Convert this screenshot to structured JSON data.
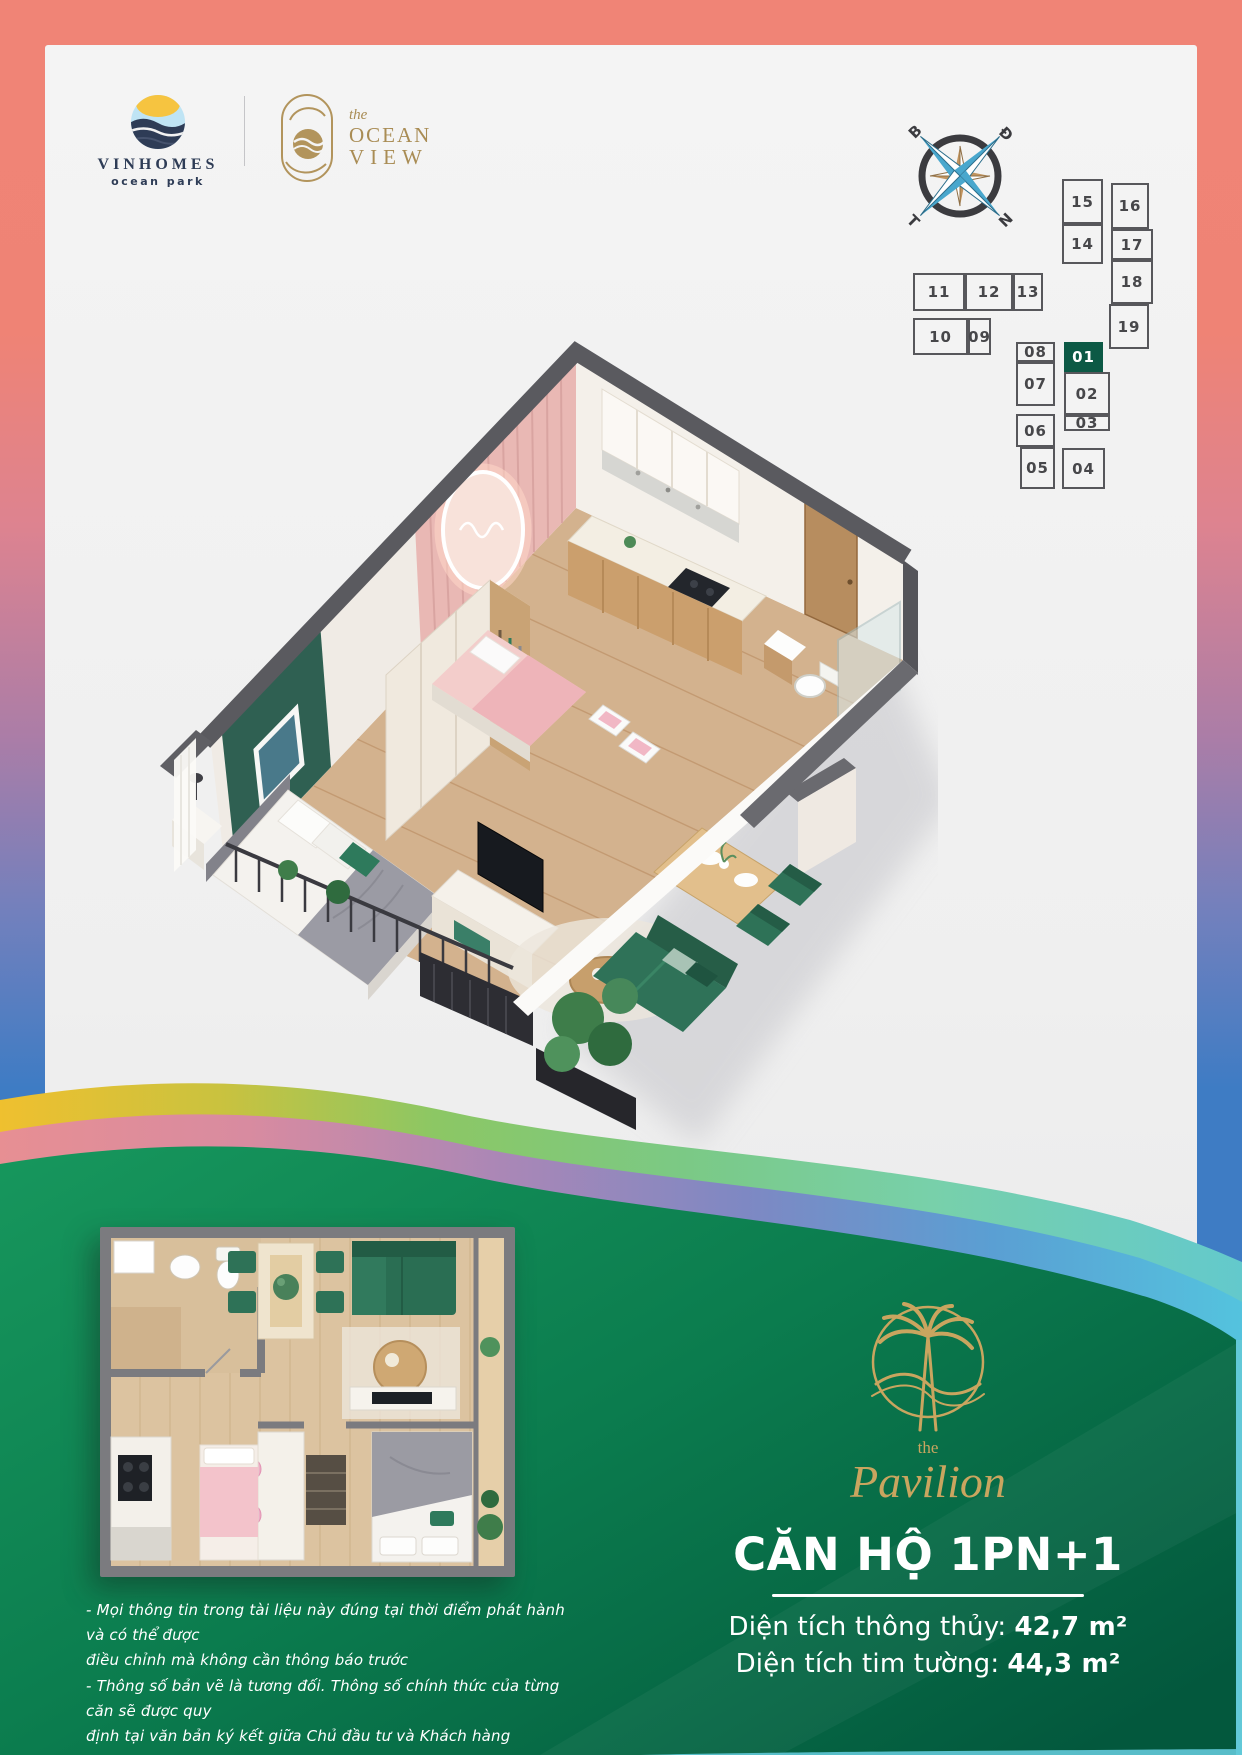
{
  "header": {
    "vinhomes": {
      "name": "VINHOMES",
      "subtitle": "ocean park"
    },
    "ocean_view": {
      "prefix": "the",
      "line1": "OCEAN",
      "line2": "VIEW"
    }
  },
  "compass": {
    "north_label": "B",
    "east_label": "Đ",
    "south_label": "N",
    "west_label": "T"
  },
  "site_plan": {
    "highlighted_unit": "01",
    "units": [
      {
        "label": "15",
        "x": 1062,
        "y": 179,
        "w": 41,
        "h": 45
      },
      {
        "label": "14",
        "x": 1062,
        "y": 224,
        "w": 41,
        "h": 40
      },
      {
        "label": "16",
        "x": 1111,
        "y": 183,
        "w": 38,
        "h": 46
      },
      {
        "label": "17",
        "x": 1111,
        "y": 229,
        "w": 42,
        "h": 31
      },
      {
        "label": "18",
        "x": 1111,
        "y": 260,
        "w": 42,
        "h": 44
      },
      {
        "label": "19",
        "x": 1109,
        "y": 304,
        "w": 40,
        "h": 45
      },
      {
        "label": "11",
        "x": 913,
        "y": 273,
        "w": 52,
        "h": 38
      },
      {
        "label": "12",
        "x": 965,
        "y": 273,
        "w": 48,
        "h": 38
      },
      {
        "label": "13",
        "x": 1013,
        "y": 273,
        "w": 30,
        "h": 38
      },
      {
        "label": "10",
        "x": 913,
        "y": 318,
        "w": 55,
        "h": 37
      },
      {
        "label": "09",
        "x": 968,
        "y": 318,
        "w": 23,
        "h": 37
      },
      {
        "label": "08",
        "x": 1016,
        "y": 342,
        "w": 39,
        "h": 20
      },
      {
        "label": "07",
        "x": 1016,
        "y": 362,
        "w": 39,
        "h": 44
      },
      {
        "label": "06",
        "x": 1016,
        "y": 414,
        "w": 39,
        "h": 33
      },
      {
        "label": "05",
        "x": 1020,
        "y": 447,
        "w": 35,
        "h": 42
      },
      {
        "label": "01",
        "x": 1064,
        "y": 342,
        "w": 39,
        "h": 30,
        "highlighted": true
      },
      {
        "label": "02",
        "x": 1064,
        "y": 372,
        "w": 46,
        "h": 43
      },
      {
        "label": "03",
        "x": 1064,
        "y": 415,
        "w": 46,
        "h": 16
      },
      {
        "label": "04",
        "x": 1062,
        "y": 448,
        "w": 43,
        "h": 41
      }
    ]
  },
  "pavilion": {
    "prefix": "the",
    "name": "Pavilion"
  },
  "apartment": {
    "title": "CĂN HỘ 1PN+1",
    "areas": [
      {
        "label": "Diện tích thông thủy:",
        "value": "42,7 m²"
      },
      {
        "label": "Diện tích tim tường:",
        "value": "44,3 m²"
      }
    ]
  },
  "disclaimer": {
    "lines": [
      "- Mọi thông tin trong tài liệu này đúng tại thời điểm phát hành và có thể được",
      "điều chỉnh mà không cần thông báo trước",
      "- Thông số bản vẽ là tương đối. Thông số chính thức của từng căn sẽ được quy",
      "định tại văn bản ký kết giữa Chủ đầu tư và Khách hàng"
    ]
  },
  "colors": {
    "border_coral": "#f08476",
    "border_blue": "#3e7cc4",
    "green_dark": "#05573d",
    "green_light": "#17975d",
    "highlight_unit": "#0c5945",
    "gold": "#c9a55f"
  }
}
